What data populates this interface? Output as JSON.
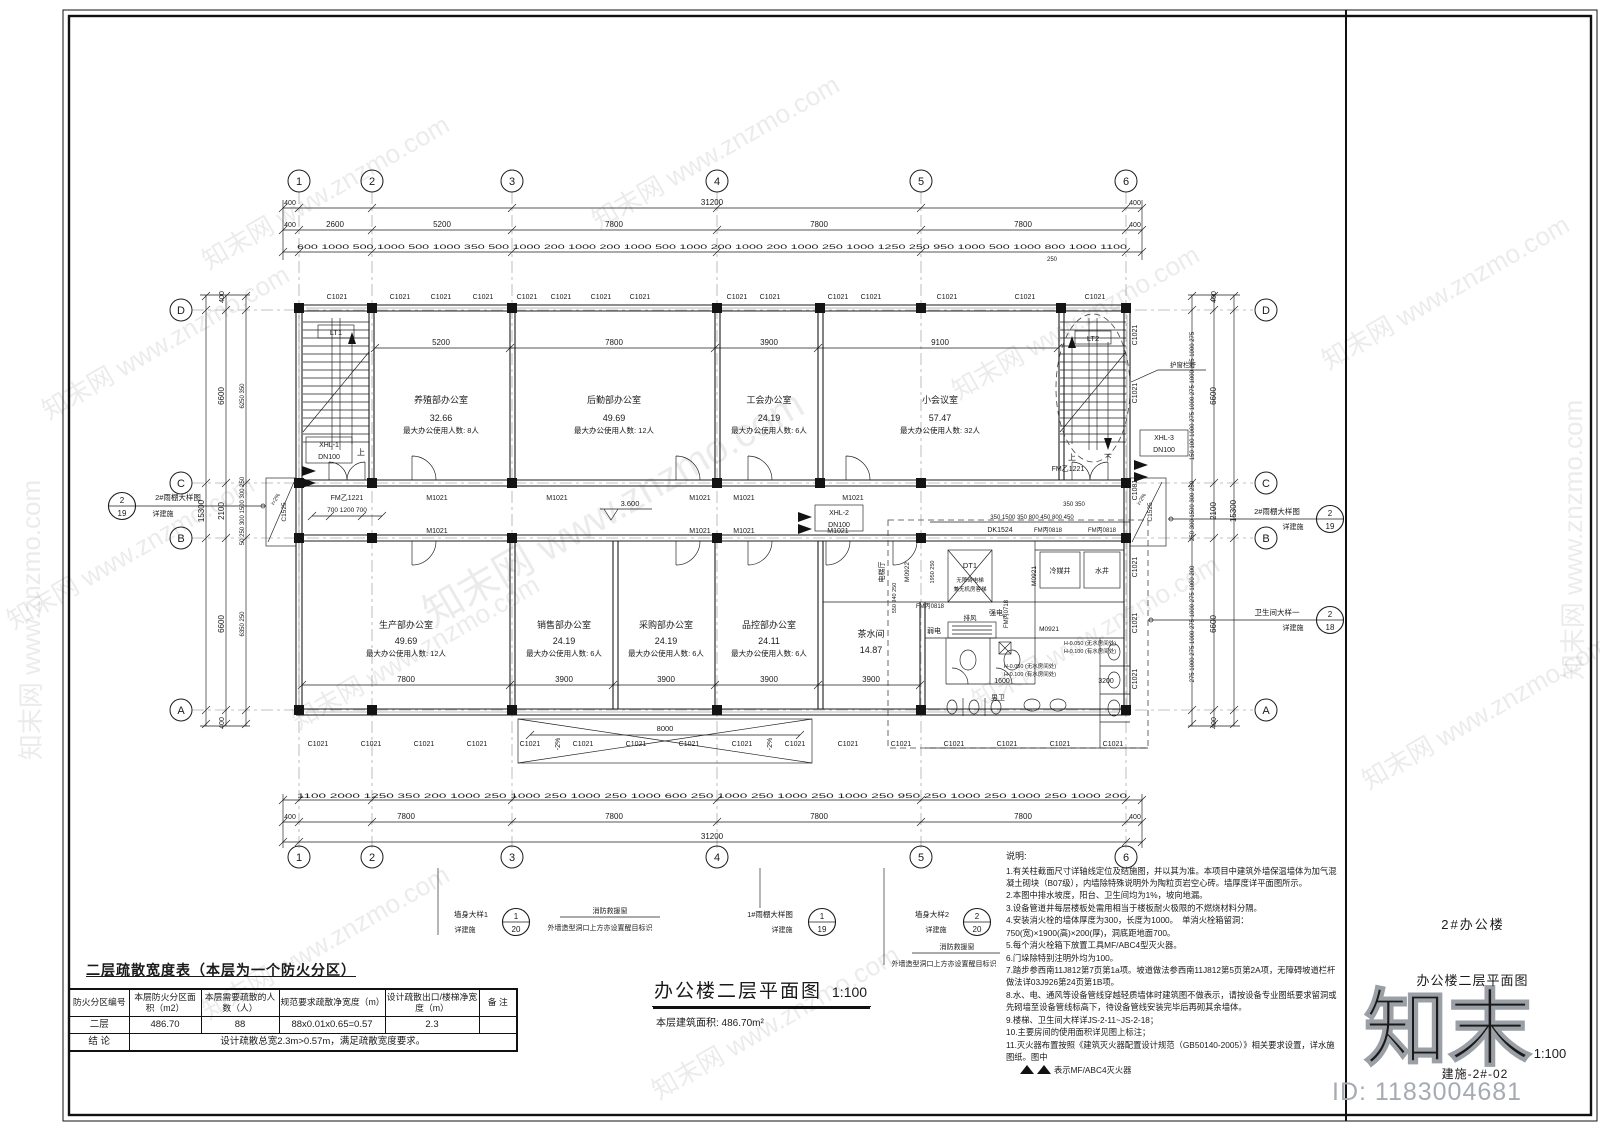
{
  "watermark": {
    "text": "知末网 www.znzmo.com",
    "logo": "知末",
    "id": "ID: 1183004681"
  },
  "title_block": {
    "project": "2#办公楼",
    "drawing_name": "办公楼二层平面图",
    "scale": "1:100",
    "sheet_no": "建施-2#-02"
  },
  "plan": {
    "caption": {
      "title": "办公楼二层平面图",
      "scale": "1:100",
      "area_note": "本层建筑面积: 486.70m²"
    },
    "grid_cols": [
      "1",
      "2",
      "3",
      "4",
      "5",
      "6"
    ],
    "grid_rows": [
      "A",
      "B",
      "C",
      "D"
    ],
    "rooms": [
      {
        "name": "养殖部办公室",
        "area": "32.66",
        "occ": "最大办公使用人数: 8人"
      },
      {
        "name": "后勤部办公室",
        "area": "49.69",
        "occ": "最大办公使用人数: 12人"
      },
      {
        "name": "工会办公室",
        "area": "24.19",
        "occ": "最大办公使用人数: 6人"
      },
      {
        "name": "小会议室",
        "area": "57.47",
        "occ": "最大办公使用人数: 32人"
      },
      {
        "name": "生产部办公室",
        "area": "49.69",
        "occ": "最大办公使用人数: 12人"
      },
      {
        "name": "销售部办公室",
        "area": "24.19",
        "occ": "最大办公使用人数: 6人"
      },
      {
        "name": "采购部办公室",
        "area": "24.19",
        "occ": "最大办公使用人数: 6人"
      },
      {
        "name": "品控部办公室",
        "area": "24.11",
        "occ": "最大办公使用人数: 6人"
      },
      {
        "name": "茶水间",
        "area": "14.87"
      },
      {
        "name": "男卫"
      }
    ],
    "core": {
      "hall": "电梯厅",
      "elevator_tag": "DT1",
      "elevator_note1": "无障碍电梯",
      "elevator_note2": "兼无机房客梯",
      "shaft1": "冷媒井",
      "shaft2": "水井",
      "strong": "强电",
      "weak": "弱电",
      "exhaust": "排风",
      "level_note1": "H-0.050 (无水房间处)",
      "level_note2": "H-0.100 (有水房间处)"
    },
    "stairs": {
      "lt1": "LT1",
      "lt2": "LT2",
      "up": "上",
      "down": "下",
      "rail": "护窗栏杆"
    },
    "codes": {
      "c1021": "C1021",
      "c1525": "C1525",
      "c1081": "C1081",
      "m1021": "M1021",
      "m0921": "M0921",
      "m0922": "M0922",
      "fmy1221": "FM乙1221",
      "fmb0818": "FM丙0818",
      "fmb0718": "FM丙0718",
      "dk1524": "DK1524",
      "xhl1": "XHL-1",
      "xhl2": "XHL-2",
      "xhl3": "XHL-3",
      "dn100": "DN100"
    },
    "slopes": {
      "level": "3.600",
      "canopy": "-2%",
      "window": "i=2%"
    },
    "dims": {
      "d31200": "31200",
      "d15300": "15300",
      "d400": "400",
      "d2600": "2600",
      "d5200": "5200",
      "d7800": "7800",
      "d3900": "3900",
      "d9100": "9100",
      "d6600": "6600",
      "d2100": "2100",
      "d8000": "8000",
      "d1600": "1600",
      "d3200": "3200",
      "d250": "250",
      "top_detail": "600 1000 500 1000 500 1000 350 500 1000 200 1000 200 1000 500 1000 200 1000 200 1000 250 1000 1250 250 950 1000 500 1000 800 1000 1100",
      "bottom_detail": "1100 2000 1250 350 200 1000 250 1000 250 1000 250 1000 600 250 1000 250 1000 250 1000 250 950 250 1000 250 1000 250 1000 200",
      "left_dc": "6250 350",
      "left_cb": "50 250 300 1500 300 250",
      "left_ba": "6350 250",
      "right_dc": "150 100 1000 275 1000 275 1000 275 1000 275",
      "right_cb": "250 300 1500 300 250",
      "right_ba": "275 1000 275 1000 275 1000 275 1000 200",
      "core_top": "350 1500 350 800 450 800 450",
      "core_top2": "350  350",
      "lift_side": "550 940 250",
      "lift_side2": "1950 250",
      "entrance": "700 1200 700"
    },
    "callouts": {
      "canopy2": {
        "label": "2#雨棚大样图",
        "detail": "详建施",
        "num": "2",
        "sheet": "19"
      },
      "wc": {
        "label": "卫生间大样一",
        "detail": "详建施",
        "num": "2",
        "sheet": "18"
      },
      "wall1": {
        "label": "墙身大样1",
        "detail": "详建施",
        "num": "1",
        "sheet": "20"
      },
      "canopy1": {
        "label": "1#雨棚大样图",
        "detail": "详建施",
        "num": "1",
        "sheet": "19"
      },
      "wall2": {
        "label": "墙身大样2",
        "detail": "详建施",
        "num": "2",
        "sheet": "20"
      },
      "rescue1": "消防救援窗",
      "rescue2": "外墙造型洞口上方亦设置醒目标识"
    }
  },
  "evac_table": {
    "title": "二层疏散宽度表（本层为一个防火分区）",
    "headers": [
      "防火分区编号",
      "本层防火分区面积（m2）",
      "本层需要疏散的人数（人）",
      "规范要求疏散净宽度（m）",
      "设计疏散出口/楼梯净宽度（m）",
      "备  注"
    ],
    "row": [
      "二层",
      "486.70",
      "88",
      "88x0.01x0.65=0.57",
      "2.3",
      ""
    ],
    "conclusion_label": "结  论",
    "conclusion": "设计疏散总宽2.3m>0.57m，满足疏散宽度要求。"
  },
  "notes": {
    "title": "说明:",
    "items": [
      "1.有关柱截面尺寸详轴线定位及结施图，并以其为准。本项目中建筑外墙保温墙体为加气混凝土砌块（B07级），内墙除特殊说明外为陶粒页岩空心砖。墙厚度详平面图所示。",
      "2.本图中排水坡度，阳台、卫生间均为1%，坡向地漏。",
      "3.设备管道井每层楼板处需用相当于楼板耐火极限的不燃烧材料分隔。",
      "4.安装消火栓的墙体厚度为300，长度为1000。　单消火栓箱留洞：750(宽)×1900(高)×200(厚)，洞底距地面700。",
      "5.每个消火栓箱下放置工具MF/ABC4型灭火器。",
      "6.门垛除特别注明外均为100。",
      "7.踏步参西南11J812第7页第1a项。坡道做法参西南11J812第5页第2A项，无障碍坡道栏杆做法详03J926第24页第1B项。",
      "8.水、电、通风等设备管线穿越轻质墙体时建筑图不做表示，请按设备专业图纸要求留洞或先砌墙至设备管线标高下，待设备管线安装完毕后再砌其余墙体。",
      "9.楼梯、卫生间大样详JS-2-11~JS-2-18；",
      "10.主要房间的使用面积详见图上标注；",
      "11.灭火器布置按照《建筑灭火器配置设计规范（GB50140-2005）》相关要求设置，详水施图纸。图中"
    ],
    "legend": "表示MF/ABC4灭火器"
  }
}
